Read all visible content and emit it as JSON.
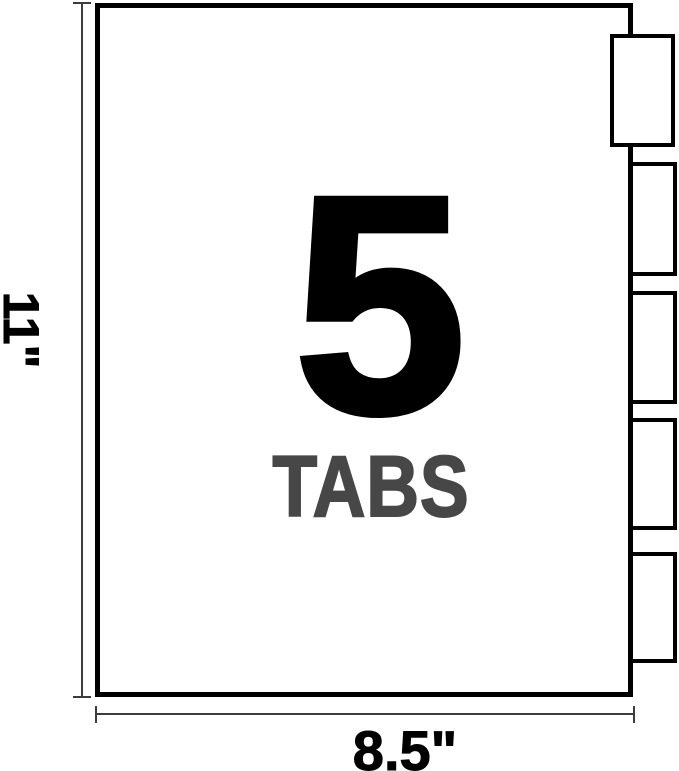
{
  "figure": {
    "tab_count": 5,
    "tab_count_label": "5",
    "tabs_word": "TABS",
    "height_label": "11\"",
    "width_label": "8.5\""
  },
  "colors": {
    "line": "#000000",
    "tabs_word": "#474747",
    "dim": "#3c3c3c",
    "bg": "#ffffff"
  }
}
